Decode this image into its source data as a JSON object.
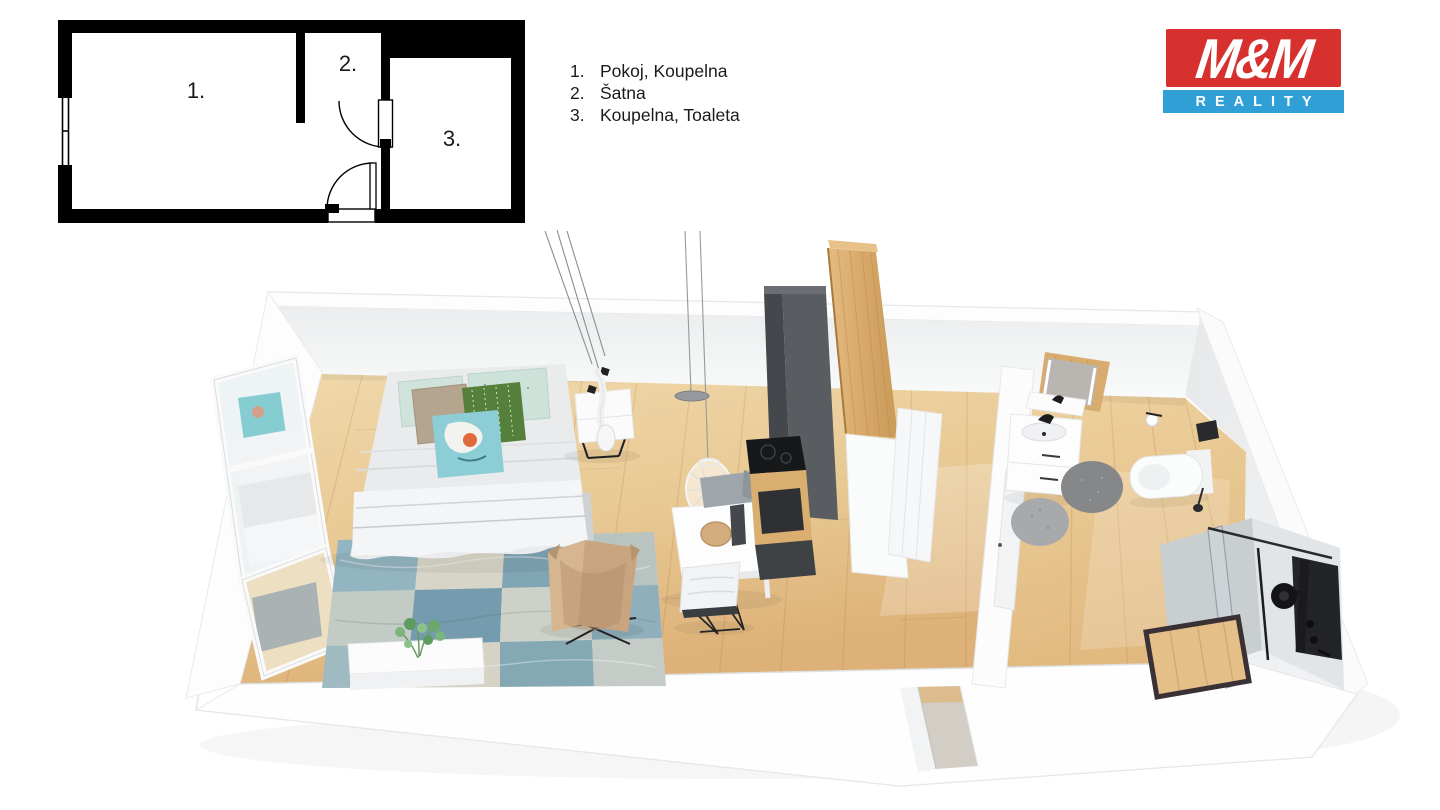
{
  "header": {
    "legend": {
      "items": [
        {
          "num": "1.",
          "label": "Pokoj, Koupelna"
        },
        {
          "num": "2.",
          "label": "Šatna"
        },
        {
          "num": "3.",
          "label": "Koupelna, Toaleta"
        }
      ]
    },
    "logo": {
      "title": "M&M",
      "subtitle": "REALITY",
      "title_bg": "#d6302f",
      "subtitle_bg": "#2f9fd6",
      "text_color": "#ffffff"
    }
  },
  "floorplan_2d": {
    "rooms": [
      {
        "number": "1."
      },
      {
        "number": "2."
      },
      {
        "number": "3."
      }
    ],
    "wall_color": "#000000"
  },
  "scene_3d": {
    "palette": {
      "floor_wood_light": "#f0d8ab",
      "floor_wood_dark": "#ddb47c",
      "wall_white": "#ffffff",
      "wall_shadow": "#e9ebed",
      "kitchen_dark": "#54585c",
      "wood_panel": "#d8aa6c",
      "rug_blue": "#8fb2bf",
      "rug_cream": "#d6d3c6",
      "chair_tan": "#d0b08a",
      "bath_rug_grey": "#8a8c8e",
      "fixture_black": "#1c1c1e",
      "pillow_mint": "#cfe3da",
      "pillow_green": "#54803b",
      "pillow_teal": "#8ccdd6",
      "pillow_beige": "#b5a48e"
    }
  }
}
